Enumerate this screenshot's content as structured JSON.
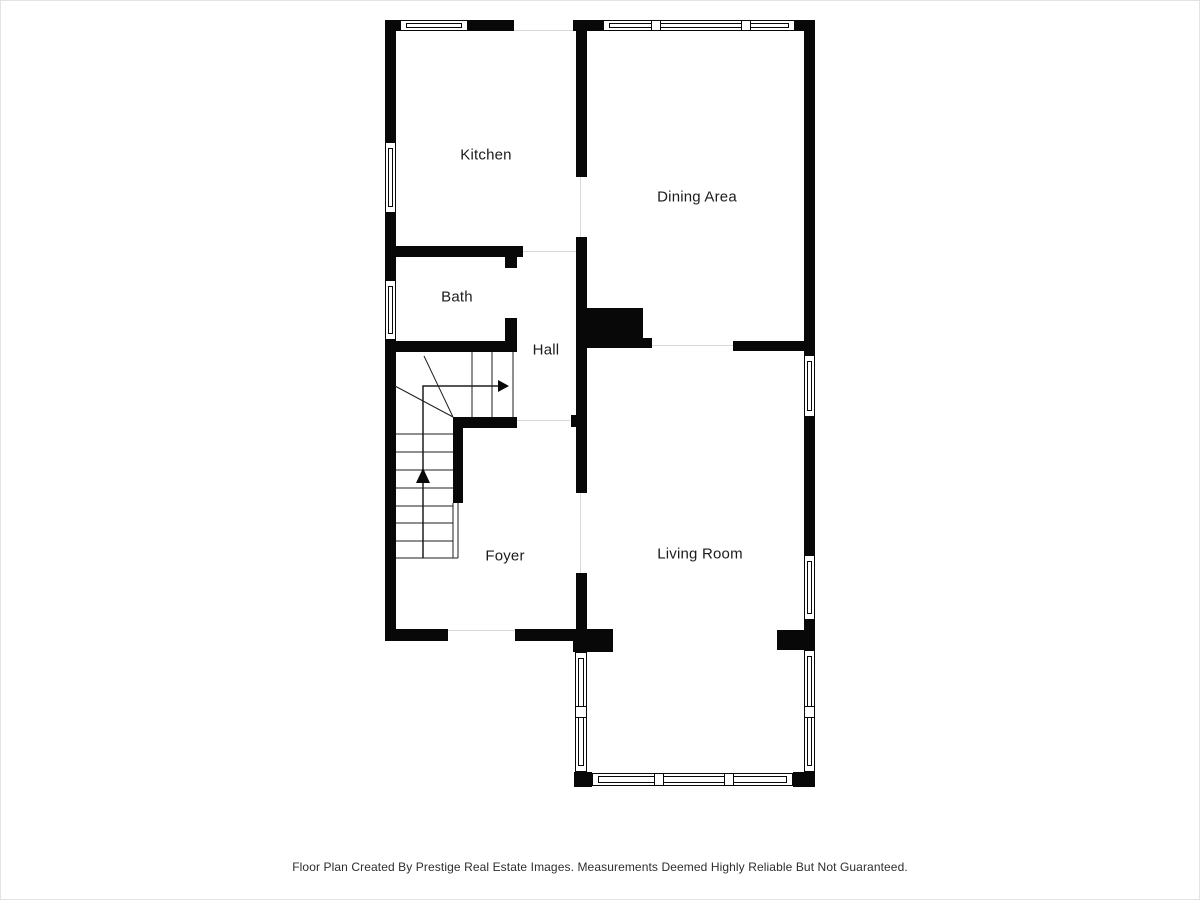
{
  "document": {
    "type": "floor-plan",
    "footer_text": "Floor Plan Created By Prestige Real Estate Images. Measurements Deemed Highly Reliable But Not Guaranteed."
  },
  "plan": {
    "rooms": {
      "kitchen": "Kitchen",
      "dining_area": "Dining Area",
      "bath": "Bath",
      "hall": "Hall",
      "foyer": "Foyer",
      "living_room": "Living Room"
    },
    "stairs": {
      "direction_arrows": [
        "up",
        "right"
      ]
    },
    "colors": {
      "wall": "#080808",
      "background": "#ffffff",
      "label_text": "#1b1b1b",
      "opening_line": "#d8d8d8"
    }
  }
}
